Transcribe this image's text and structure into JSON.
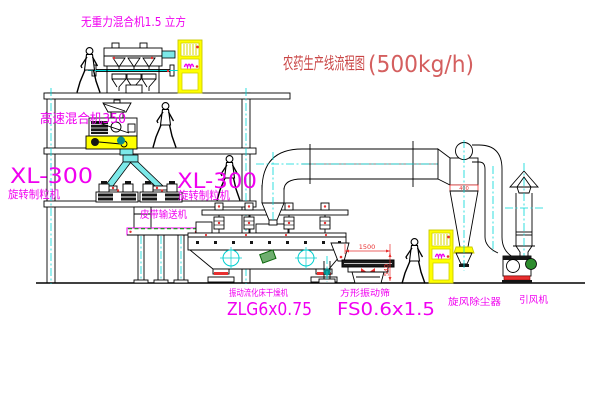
{
  "title": {
    "name": "农药生产线流程图",
    "capacity": "(500kg/h)"
  },
  "equipment_labels": {
    "gravity_mixer": "无重力混合机1.5 立方",
    "high_speed_mixer": "高速混合机350",
    "granulator_left": {
      "model": "XL-300",
      "name": "旋转制粒机"
    },
    "granulator_right": {
      "model": "XL-300",
      "name": "旋转制粒机"
    },
    "belt_conveyor": "皮带输送机",
    "fluid_bed_dryer": {
      "name": "振动流化床干燥机",
      "model": "ZLG6x0.75"
    },
    "vibrating_sieve": {
      "name": "方形振动筛",
      "model": "FS0.6x1.5"
    },
    "cyclone": "旋风除尘器",
    "induced_draft_fan": "引风机"
  },
  "dimensions": {
    "sieve_length": "1500",
    "sieve_height": "540",
    "cyclone_inlet": "400"
  },
  "colors": {
    "background": "#ffffff",
    "line_black": "#000000",
    "label_magenta": "#f000f0",
    "title_red": "#c94545",
    "centerline_cyan": "#00d8d8",
    "equipment_yellow": "#ffff00",
    "accent_red": "#e83030",
    "accent_green": "#2d8c2d"
  }
}
